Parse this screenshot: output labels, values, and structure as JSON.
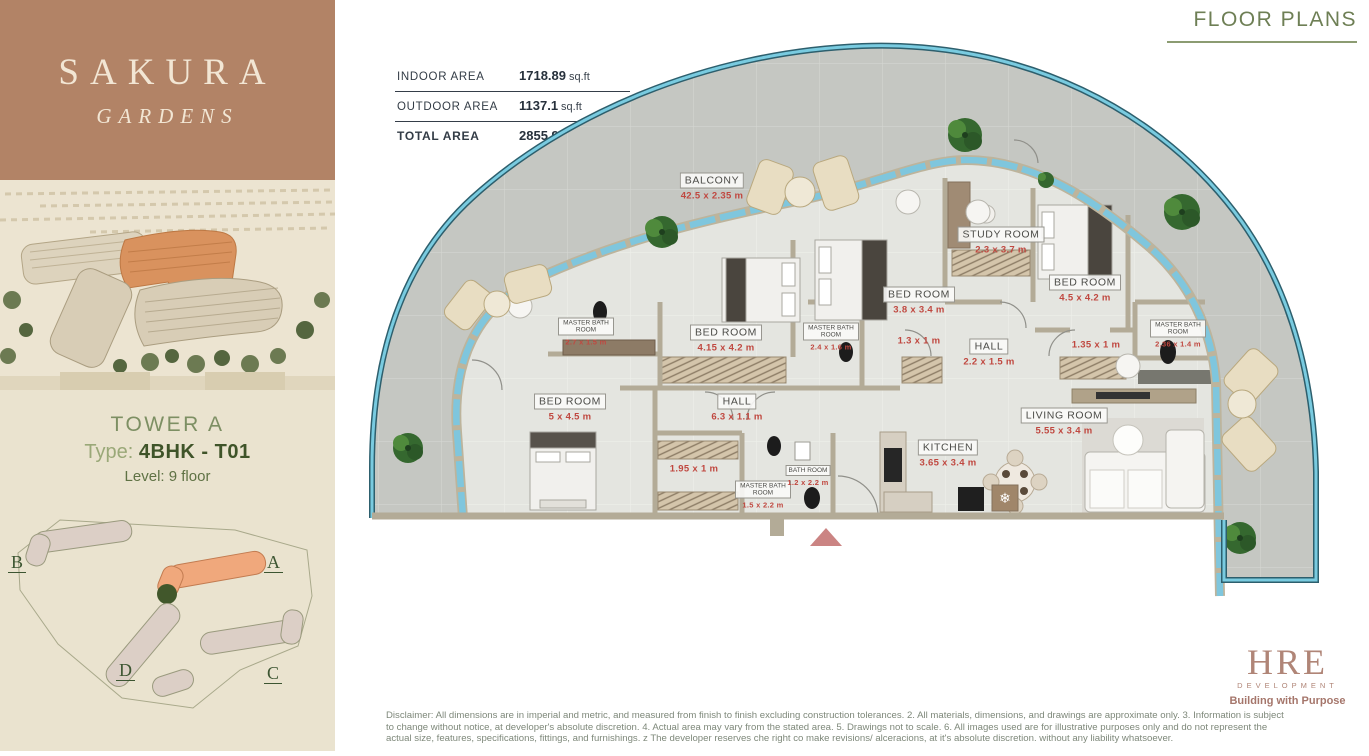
{
  "header": {
    "title": "FLOOR PLANS"
  },
  "sidebar": {
    "brand": {
      "title": "SAKURA",
      "subtitle": "GARDENS"
    },
    "unit": {
      "tower": "TOWER A",
      "type_label": "Type:",
      "type_value": "4BHK - T01",
      "level_label": "Level:",
      "level_value": "9 floor"
    },
    "sitemap": {
      "buildings": [
        {
          "label": "B"
        },
        {
          "label": "A"
        },
        {
          "label": "D"
        },
        {
          "label": "C"
        }
      ]
    }
  },
  "area_table": {
    "rows": [
      {
        "label": "INDOOR AREA",
        "value": "1718.89",
        "unit": "sq.ft"
      },
      {
        "label": "OUTDOOR AREA",
        "value": "1137.1",
        "unit": "sq.ft"
      },
      {
        "label": "TOTAL AREA",
        "value": "2855.99",
        "unit": "sq.ft"
      }
    ]
  },
  "plan": {
    "rooms": [
      {
        "name": "BALCONY",
        "dims": "42.5 x 2.35 m"
      },
      {
        "name": "STUDY ROOM",
        "dims": "2.3 x 3.7 m"
      },
      {
        "name": "BED ROOM",
        "dims": "4.5 x 4.2 m"
      },
      {
        "name": "BED ROOM",
        "dims": "3.8 x 3.4 m"
      },
      {
        "name": "BED ROOM",
        "dims": "4.15 x 4.2 m"
      },
      {
        "name": "BED ROOM",
        "dims": "5 x 4.5 m"
      },
      {
        "name": "MASTER BATH ROOM",
        "dims": "2.7 x 1.5 m"
      },
      {
        "name": "MASTER BATH ROOM",
        "dims": "2.4 x 1.6 m"
      },
      {
        "name": "MASTER BATH ROOM",
        "dims": "2.36 x 1.4 m"
      },
      {
        "name": "MASTER BATH ROOM",
        "dims": "1.5 x 2.2 m"
      },
      {
        "name": "BATH ROOM",
        "dims": "1.2 x 2.2 m"
      },
      {
        "name": "HALL",
        "dims": "2.2 x 1.5 m"
      },
      {
        "name": "HALL",
        "dims": "6.3 x 1.1 m"
      },
      {
        "name": "KITCHEN",
        "dims": "3.65 x 3.4 m"
      },
      {
        "name": "LIVING ROOM",
        "dims": "5.55 x 3.4 m"
      },
      {
        "name": "",
        "dims": "1.3 x 1 m"
      },
      {
        "name": "",
        "dims": "1.35 x 1 m"
      },
      {
        "name": "",
        "dims": "1.95 x 1 m"
      }
    ]
  },
  "footer": {
    "logo": {
      "name": "HRE",
      "sub": "DEVELOPMENT",
      "tagline": "Building with Purpose"
    },
    "disclaimer": "Disclaimer: All dimensions are in imperial and metric, and measured from finish to finish excluding construction tolerances. 2. All materials, dimensions, and drawings are approximate only. 3. Information is subject to change without notice, at developer's absolute discretion. 4. Actual area may vary from the stated area. 5. Drawings not to scale. 6. All images used are for illustrative purposes only and do not represent the actual size, features, specifications, fittings, and furnishings. z The developer reserves che right co make revisions/ alceracions, at it's absolute discretion. without any liability whatsoever."
  },
  "colors": {
    "brand_brown": "#b28366",
    "accent_orange": "#eda87e",
    "glazing_blue": "#7fc6dd",
    "dims_red": "#c04840",
    "heading_green": "#6e7f55"
  }
}
